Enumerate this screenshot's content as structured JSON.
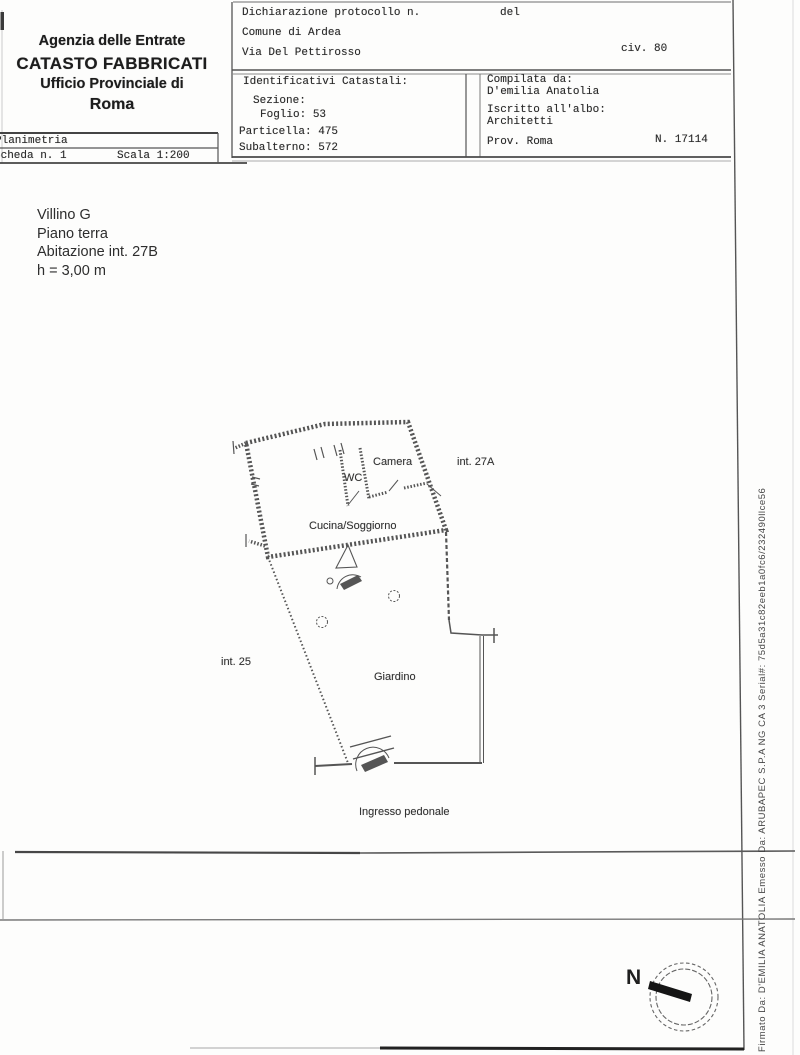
{
  "document": {
    "agency_header": {
      "line1": "Agenzia delle Entrate",
      "line2": "CATASTO FABBRICATI",
      "line3": "Ufficio Provinciale di",
      "line4": "Roma"
    },
    "sheet_info": {
      "type_label": "Planimetria",
      "sheet_label": "Scheda n. 1",
      "scale_label": "Scala 1:200"
    },
    "declaration": {
      "protocol_label": "Dichiarazione protocollo n.",
      "date_label": "del",
      "municipality": "Comune di Ardea",
      "street": "Via Del Pettirosso",
      "civic_number": "civ. 80"
    },
    "cadastral_ids": {
      "title": "Identificativi Catastali:",
      "sezione_label": "Sezione:",
      "sezione_value": "",
      "foglio_label": "Foglio:",
      "foglio_value": "53",
      "particella_label": "Particella:",
      "particella_value": "475",
      "subalterno_label": "Subalterno:",
      "subalterno_value": "572"
    },
    "compiler": {
      "compiled_by_label": "Compilata da:",
      "compiled_by_name": "D'emilia Anatolia",
      "registered_label": "Iscritto all'albo:",
      "registered_order": "Architetti",
      "province": "Prov. Roma",
      "registration_number": "N. 17114"
    },
    "property_description": {
      "line1": "Villino G",
      "line2": "Piano terra",
      "line3": "Abitazione int. 27B",
      "line4": "h = 3,00 m"
    },
    "floor_plan": {
      "labels": {
        "bedroom": "Camera",
        "bathroom": "WC",
        "kitchen_living": "Cucina/Soggiorno",
        "garden": "Giardino",
        "adjacent_unit_right": "int. 27A",
        "adjacent_unit_left": "int. 25",
        "pedestrian_entrance": "Ingresso pedonale"
      }
    },
    "compass": {
      "north_label": "N"
    },
    "signature_strip": {
      "text": "Firmato Da: D'EMILIA ANATOLIA Emesso Da: ARUBAPEC S.P.A NG CA 3 Serial#: 75d5a31c82eeb1a0fc6/232490llce56"
    }
  },
  "colors": {
    "ink": "#222222",
    "line_dark": "#444444",
    "line_mid": "#555555",
    "paper": "#fdfdfc"
  }
}
